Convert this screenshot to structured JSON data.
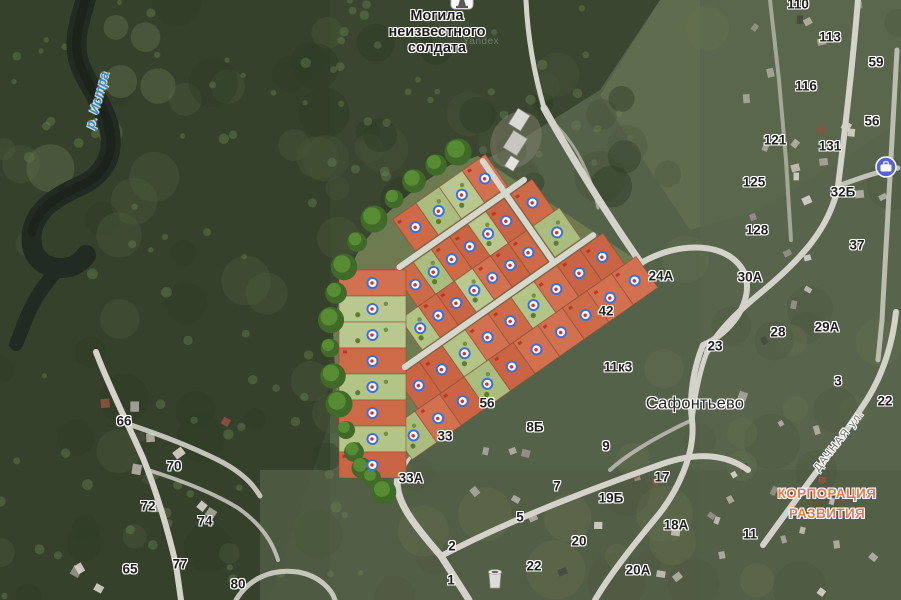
{
  "watermark": "Yandex",
  "colors": {
    "plot_orange": [
      "#cd6b48",
      "#c96545",
      "#d27150",
      "#c66243"
    ],
    "plot_green": [
      "#b3c487",
      "#abbd7e",
      "#b9c88f"
    ],
    "plot_border": "#8a4a33",
    "marker_ring": "#3e6fd9",
    "marker_dot": "#dc3726",
    "org_label": "#ec7848",
    "water_label": "#3f87c9",
    "tree_dark": "#3f6a28",
    "tree_light": "#5c9136",
    "poi_business": "#5663d4"
  },
  "labels": {
    "memorial": {
      "lines": [
        "Могила",
        "неизвестного",
        "солдата"
      ],
      "x": 437,
      "y": 33
    },
    "place": [
      {
        "t": "Сафонтьево",
        "x": 695,
        "y": 404
      }
    ],
    "org": {
      "lines": [
        "КОРПОРАЦИЯ",
        "РАЗВИТИЯ"
      ],
      "x": 827,
      "y": 504
    },
    "water": [
      {
        "t": "р. Истра",
        "x": 97,
        "y": 100,
        "rot": -75
      }
    ],
    "street": [
      {
        "t": "ДАЧНАЯ ул.",
        "x": 839,
        "y": 441,
        "rot": -52
      }
    ],
    "house_numbers": [
      {
        "t": "110",
        "x": 798,
        "y": 4
      },
      {
        "t": "113",
        "x": 830,
        "y": 37
      },
      {
        "t": "59",
        "x": 876,
        "y": 62
      },
      {
        "t": "116",
        "x": 806,
        "y": 86
      },
      {
        "t": "56",
        "x": 872,
        "y": 121
      },
      {
        "t": "121",
        "x": 775,
        "y": 140
      },
      {
        "t": "131",
        "x": 830,
        "y": 146
      },
      {
        "t": "125",
        "x": 754,
        "y": 182
      },
      {
        "t": "32Б",
        "x": 843,
        "y": 192
      },
      {
        "t": "128",
        "x": 757,
        "y": 230
      },
      {
        "t": "37",
        "x": 857,
        "y": 245
      },
      {
        "t": "24А",
        "x": 661,
        "y": 276
      },
      {
        "t": "30А",
        "x": 750,
        "y": 277
      },
      {
        "t": "42",
        "x": 606,
        "y": 311
      },
      {
        "t": "29А",
        "x": 827,
        "y": 327
      },
      {
        "t": "28",
        "x": 778,
        "y": 332
      },
      {
        "t": "23",
        "x": 715,
        "y": 346
      },
      {
        "t": "11к3",
        "x": 618,
        "y": 367
      },
      {
        "t": "3",
        "x": 838,
        "y": 381
      },
      {
        "t": "22",
        "x": 885,
        "y": 401
      },
      {
        "t": "56",
        "x": 487,
        "y": 403
      },
      {
        "t": "8Б",
        "x": 535,
        "y": 427
      },
      {
        "t": "33",
        "x": 445,
        "y": 436
      },
      {
        "t": "9",
        "x": 606,
        "y": 446
      },
      {
        "t": "17",
        "x": 662,
        "y": 477
      },
      {
        "t": "33А",
        "x": 411,
        "y": 478
      },
      {
        "t": "7",
        "x": 557,
        "y": 486
      },
      {
        "t": "19Б",
        "x": 611,
        "y": 498
      },
      {
        "t": "5",
        "x": 520,
        "y": 517
      },
      {
        "t": "18А",
        "x": 676,
        "y": 525
      },
      {
        "t": "11",
        "x": 750,
        "y": 534
      },
      {
        "t": "20",
        "x": 579,
        "y": 541
      },
      {
        "t": "2",
        "x": 452,
        "y": 546
      },
      {
        "t": "22",
        "x": 534,
        "y": 566
      },
      {
        "t": "20А",
        "x": 638,
        "y": 570
      },
      {
        "t": "65",
        "x": 130,
        "y": 569
      },
      {
        "t": "1",
        "x": 451,
        "y": 580
      },
      {
        "t": "66",
        "x": 124,
        "y": 421
      },
      {
        "t": "70",
        "x": 174,
        "y": 466
      },
      {
        "t": "72",
        "x": 148,
        "y": 506
      },
      {
        "t": "74",
        "x": 205,
        "y": 521
      },
      {
        "t": "77",
        "x": 180,
        "y": 564
      },
      {
        "t": "80",
        "x": 238,
        "y": 584
      }
    ]
  },
  "site_plan": {
    "angle": -35,
    "pivot": [
      500,
      320
    ],
    "strips": [
      {
        "y": 176,
        "h": 39,
        "segments": [
          {
            "x0": 470,
            "x1": 583,
            "colors": [
              "o",
              "g",
              "g",
              "o"
            ]
          }
        ]
      },
      {
        "y": 223,
        "h": 39,
        "segments": [
          {
            "x0": 440,
            "x1": 573,
            "colors": [
              "o",
              "g",
              "o",
              "o",
              "g",
              "o"
            ]
          },
          {
            "x0": 581,
            "x1": 607,
            "colors": [
              "o"
            ]
          }
        ]
      },
      {
        "y": 262,
        "h": 38,
        "segments": [
          {
            "x0": 419,
            "x1": 573,
            "colors": [
              "g",
              "o",
              "o",
              "g",
              "o",
              "o",
              "o"
            ]
          },
          {
            "x0": 581,
            "x1": 613,
            "colors": [
              "g"
            ]
          }
        ]
      },
      {
        "y": 308,
        "h": 38,
        "segments": [
          {
            "x0": 382,
            "x1": 634,
            "colors": [
              "o",
              "o",
              "g",
              "o",
              "o",
              "g",
              "o",
              "o",
              "o"
            ]
          }
        ]
      },
      {
        "y": 346,
        "h": 38,
        "segments": [
          {
            "x0": 348,
            "x1": 648,
            "colors": [
              "g",
              "o",
              "o",
              "g",
              "o",
              "o",
              "o",
              "o",
              "o",
              "o"
            ]
          }
        ]
      }
    ],
    "left_column": {
      "x": 339,
      "w": 67,
      "y0": 270,
      "row_h": 26,
      "colors": [
        "o",
        "g",
        "g",
        "o",
        "g",
        "o",
        "g",
        "o"
      ]
    },
    "site_roads": [
      "M448,219H600",
      "M395,304H625",
      "M577,180V302"
    ],
    "tree_line": [
      [
        458,
        152
      ],
      [
        436,
        165
      ],
      [
        414,
        181
      ],
      [
        394,
        199
      ],
      [
        374,
        219
      ],
      [
        357,
        242
      ],
      [
        344,
        267
      ],
      [
        336,
        293
      ],
      [
        331,
        320
      ],
      [
        330,
        348
      ],
      [
        333,
        376
      ],
      [
        339,
        404
      ],
      [
        346,
        430
      ],
      [
        354,
        452
      ],
      [
        362,
        468
      ],
      [
        372,
        478
      ],
      [
        384,
        492
      ]
    ]
  },
  "roads": [
    {
      "d": "M544,108 C570,155 612,222 641,263 C612,297 520,362 448,418 C421,439 403,459 398,477 C393,498 413,524 441,556 L469,600",
      "w": 7
    },
    {
      "d": "M641,263 C678,241 728,241 744,272 C756,300 730,334 703,345 C693,369 689,399 692,420 C696,452 678,492 655,519 C635,543 610,574 595,600",
      "w": 6
    },
    {
      "d": "M441,556 C512,519 591,489 662,464 C700,451 727,455 748,470",
      "w": 6
    },
    {
      "d": "M763,545 C795,500 838,445 868,398 C884,372 893,341 896,312",
      "w": 6
    },
    {
      "d": "M858,0 C853,60 845,130 838,186 C830,228 801,259 764,290 C737,312 717,332 707,352",
      "w": 6
    },
    {
      "d": "M707,352 C700,370 695,395 692,420",
      "w": 5
    },
    {
      "d": "M897,50 L892,140 887,230 882,320 878,360",
      "w": 5,
      "o": 0.8
    },
    {
      "d": "M770,0 L779,80 786,160 791,240",
      "w": 4,
      "o": 0.6
    },
    {
      "d": "M838,186 C855,180 875,172 898,168",
      "w": 5,
      "o": 0.85
    },
    {
      "d": "M96,352 C107,382 126,420 143,458 C156,490 168,530 176,565 L181,600",
      "w": 6
    },
    {
      "d": "M128,424 C158,434 190,446 218,460 C238,470 252,482 260,496",
      "w": 5,
      "o": 0.9
    },
    {
      "d": "M148,470 C180,480 212,492 238,508 C258,522 272,540 278,560",
      "w": 4,
      "o": 0.8
    },
    {
      "d": "M236,600 C248,580 270,568 298,572 C320,576 332,590 335,600",
      "w": 5,
      "o": 0.9
    },
    {
      "d": "M544,108 C536,80 528,45 526,0",
      "w": 5
    },
    {
      "d": "M548,118 C575,140 590,172 598,208",
      "w": 3,
      "o": 0.6
    },
    {
      "d": "M414,290 C406,330 400,380 398,430 L398,468",
      "w": 5
    },
    {
      "d": "M692,420 C660,435 630,452 610,470",
      "w": 4,
      "o": 0.7
    }
  ]
}
